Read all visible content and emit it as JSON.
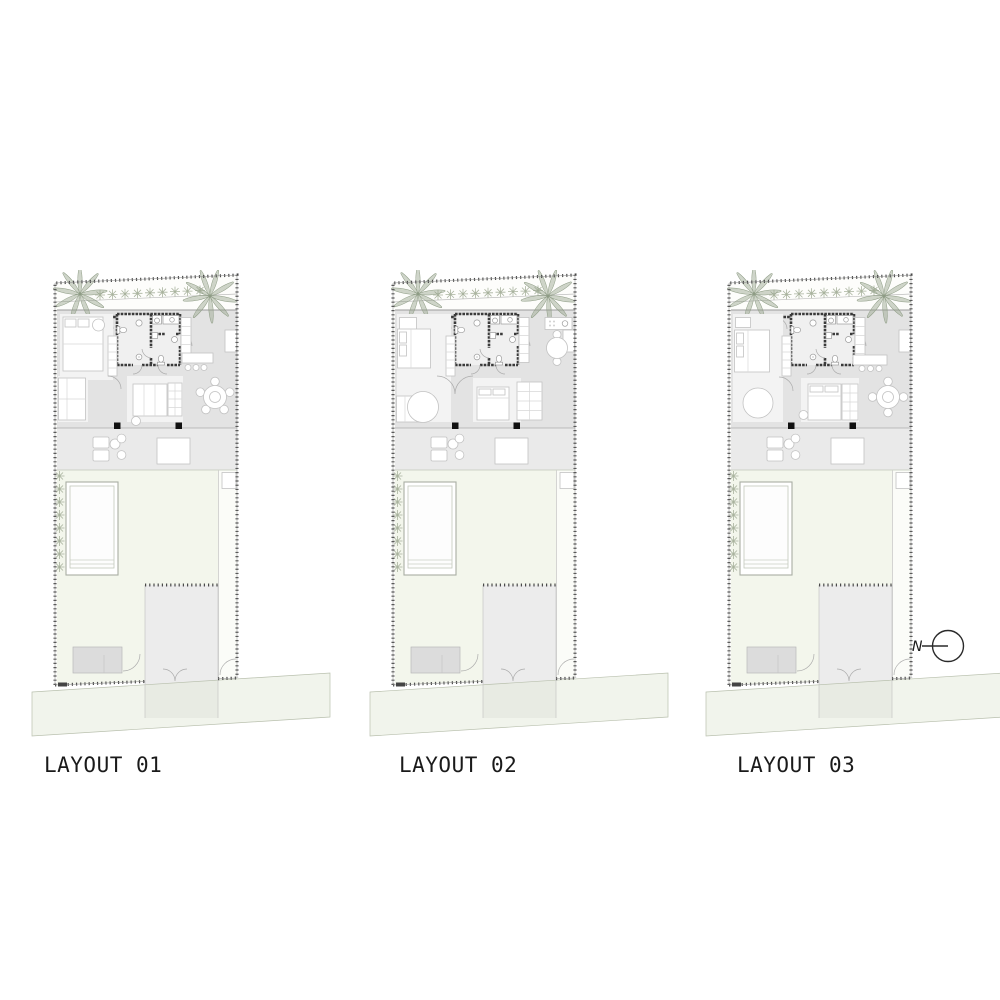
{
  "layouts": [
    {
      "id": "layout-01",
      "label": "LAYOUT 01"
    },
    {
      "id": "layout-02",
      "label": "LAYOUT 02"
    },
    {
      "id": "layout-03",
      "label": "LAYOUT 03"
    }
  ],
  "north": {
    "label": "N"
  },
  "colors": {
    "ink": "#1a1a1a",
    "wall": "#3a3a3a",
    "boundary": "#4a4a4a",
    "villa-floor": "#e3e3e3",
    "terrace-floor": "#eaeaea",
    "garden": "#f3f6ec",
    "road": "#e4e9d9",
    "driveway": "#ececec",
    "pad": "#dcdcdc",
    "furniture-line": "#c2c2c2",
    "plant": "#9aa792",
    "pool-line": "#a8aea3"
  }
}
